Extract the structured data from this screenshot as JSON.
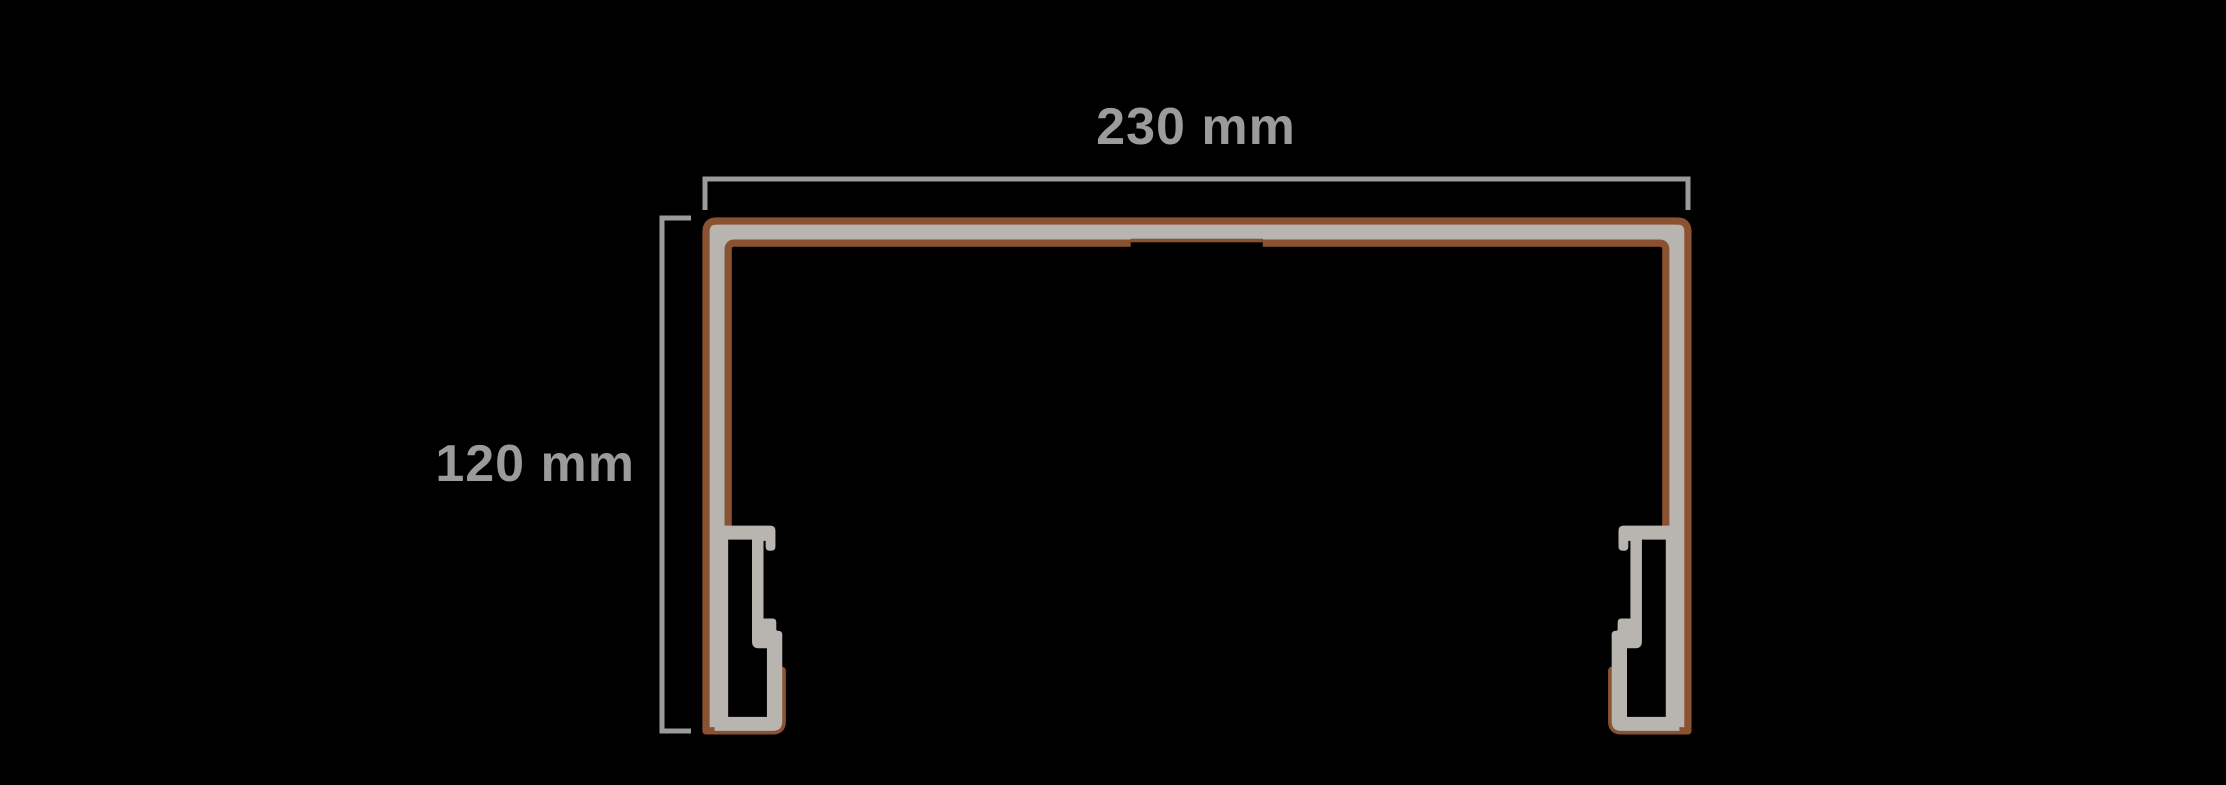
{
  "diagram": {
    "type": "aluminium-profile-cross-section",
    "width_dimension": {
      "value": 230,
      "unit": "mm",
      "label": "230 mm"
    },
    "height_dimension": {
      "value": 120,
      "unit": "mm",
      "label": "120 mm"
    },
    "colors": {
      "background": "#000000",
      "profile_fill": "#b8b5b0",
      "profile_outline": "#8a5230",
      "dimension": "#9b9b9b"
    }
  }
}
